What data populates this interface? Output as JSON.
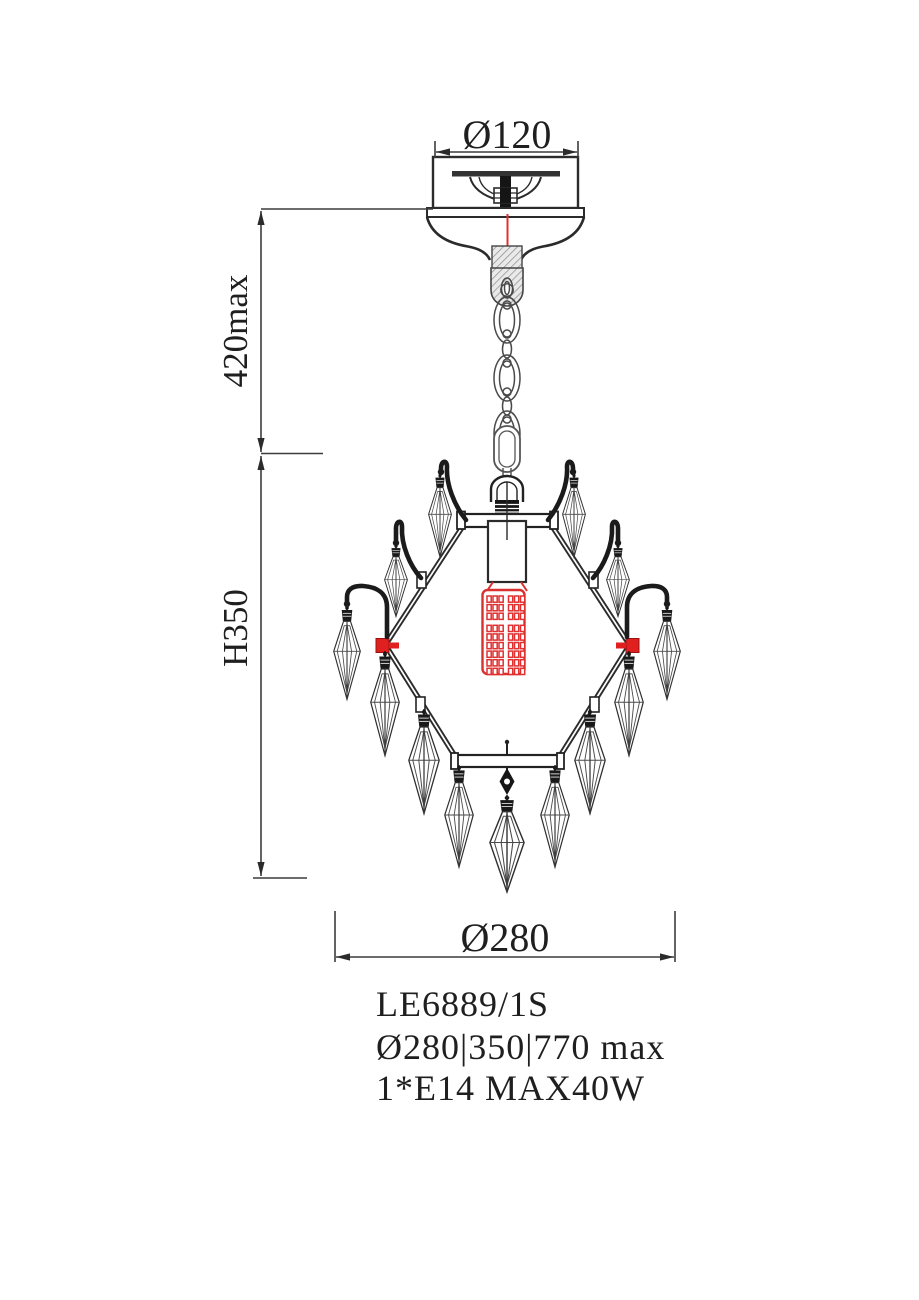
{
  "product": {
    "model": "LE6889/1S",
    "size_spec": "Ø280|350|770 max",
    "lamp_spec": "1*E14 MAX40W"
  },
  "dims": {
    "canopy_diameter": "Ø120",
    "suspension_max": "420max",
    "fixture_height": "H350",
    "fixture_diameter": "Ø280"
  },
  "drawing": {
    "type": "technical-line-drawing",
    "subject": "crystal pendant chandelier, 1 lamp, hexagonal frame with 13 crystal drops",
    "colors": {
      "line": "#2b2b2b",
      "dim_line": "#3c3c3c",
      "accent_red": "#e03030",
      "background": "#ffffff"
    }
  }
}
